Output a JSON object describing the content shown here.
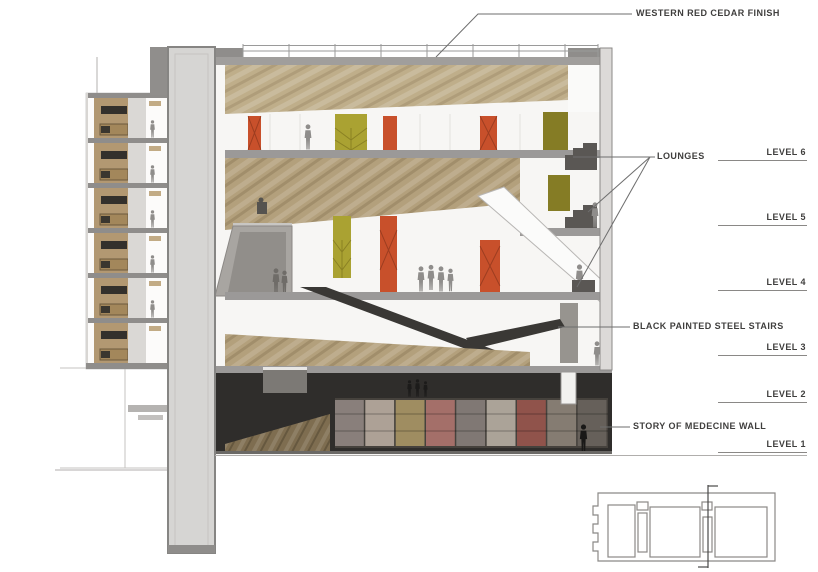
{
  "drawing": {
    "type": "architectural-building-section",
    "callouts": {
      "cedar_finish": "WESTERN RED CEDAR FINISH",
      "lounges": "LOUNGES",
      "steel_stairs": "BLACK PAINTED STEEL STAIRS",
      "medicine_wall": "STORY OF MEDECINE WALL"
    },
    "levels": [
      {
        "label": "LEVEL 6"
      },
      {
        "label": "LEVEL 5"
      },
      {
        "label": "LEVEL 4"
      },
      {
        "label": "LEVEL 3"
      },
      {
        "label": "LEVEL 2"
      },
      {
        "label": "LEVEL 1"
      }
    ],
    "colors": {
      "wood": "#b3a07c",
      "wood_light": "#bfae8a",
      "wood_floor": "#7e6d50",
      "door_orange": "#c8502b",
      "door_olive": "#aaa232",
      "olive_dark": "#857c25",
      "concrete": "#a8a5a1",
      "slab": "#9b9998",
      "shaft": "#d6d5d3",
      "dark_zone": "#2f2d2b",
      "stair_black": "#3a3835",
      "figure": "#8f8d8b",
      "label_text": "#3f3e3d",
      "leader_line": "#6e6e6e"
    },
    "medicine_wall_panels": [
      "#9a8f8b",
      "#c7b9ac",
      "#b5a06a",
      "#bb7a74",
      "#8e8682",
      "#c4bbaf",
      "#a2574f",
      "#958b80",
      "#6e6861"
    ]
  }
}
